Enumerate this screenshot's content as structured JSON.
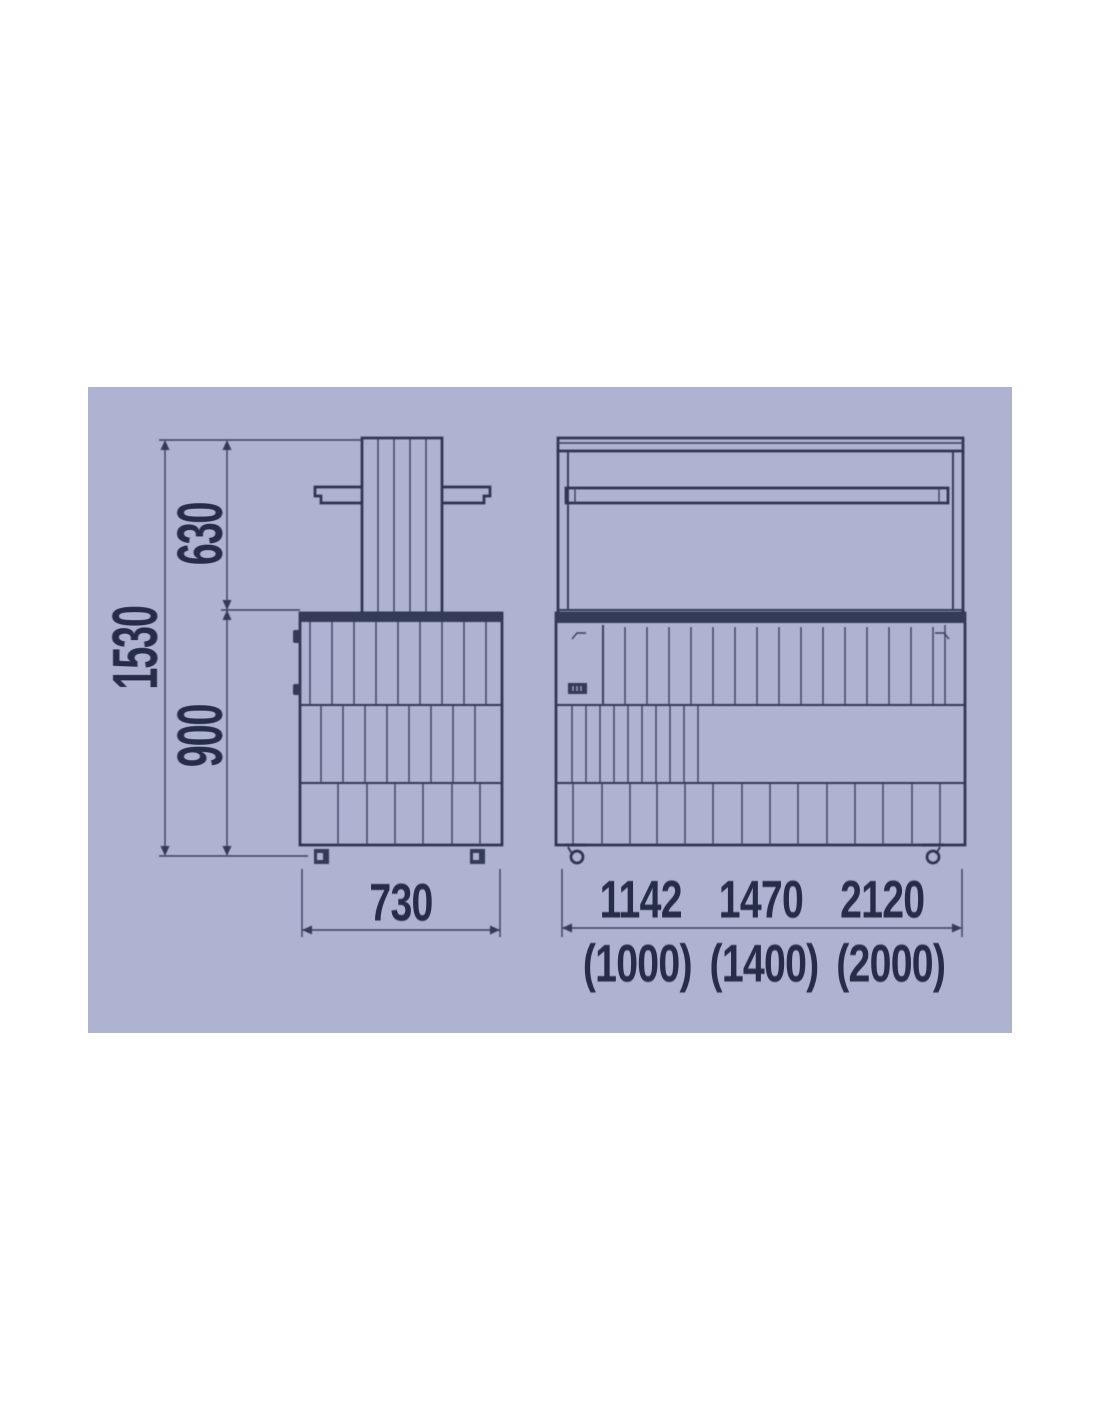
{
  "page": {
    "background": "#ffffff"
  },
  "panel": {
    "background": "#adb3d0",
    "line_color": "#2d3450",
    "text_color": "#262d49"
  },
  "drawing": {
    "type": "technical-dimension-drawing",
    "views": [
      "side-view",
      "front-view"
    ]
  },
  "dimensions": {
    "overall_height": "1530",
    "upper_section_height": "630",
    "body_height": "900",
    "depth": "730",
    "overall_widths": [
      "1142",
      "1470",
      "2120"
    ],
    "alternate_widths": [
      "(1000)",
      "(1400)",
      "(2000)"
    ]
  }
}
